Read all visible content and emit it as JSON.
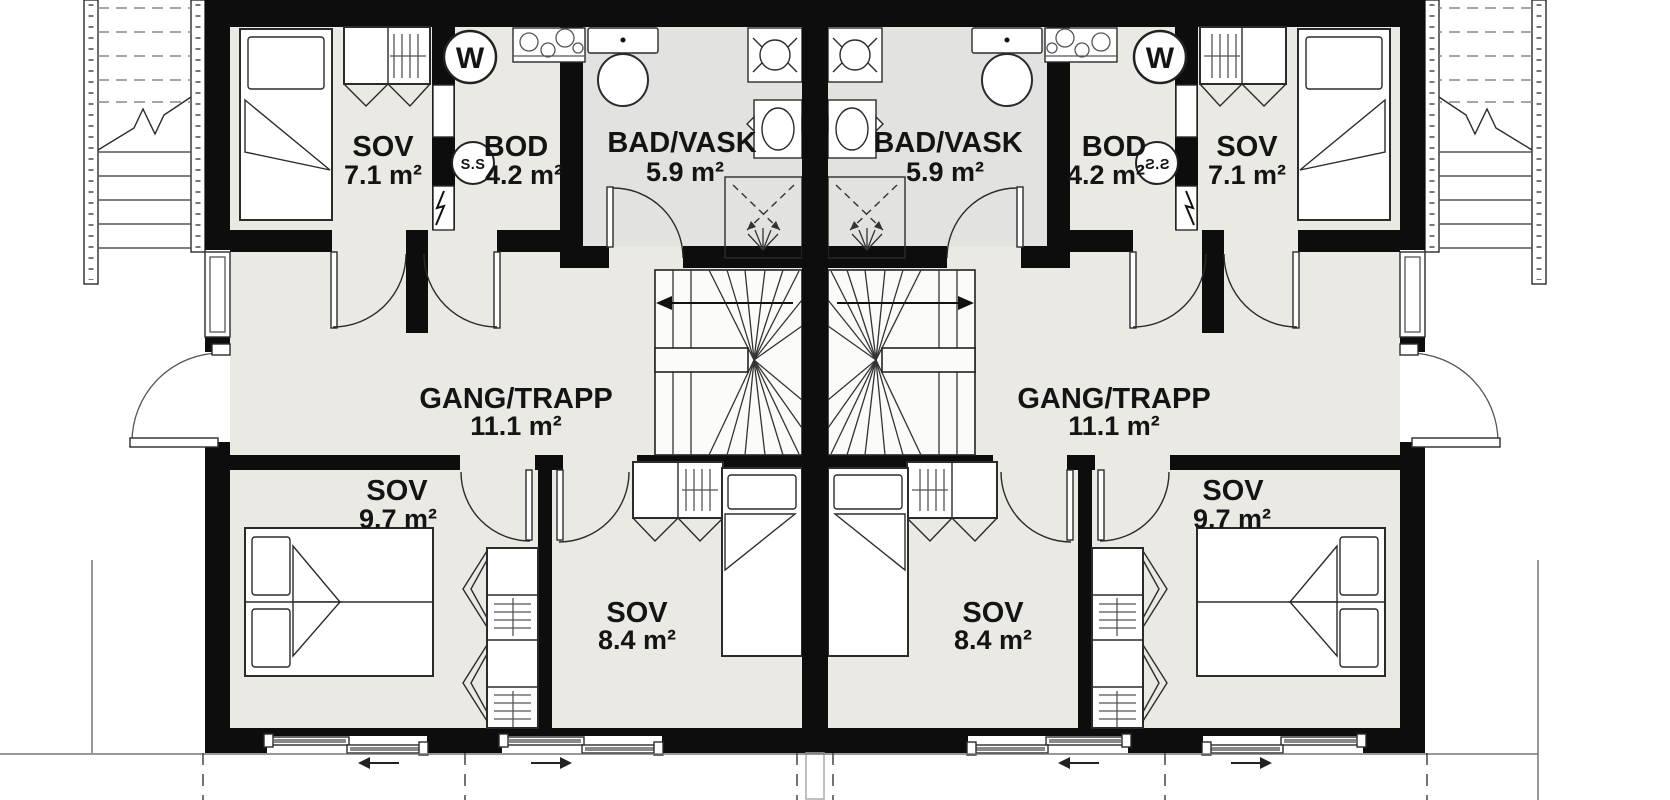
{
  "units": [
    {
      "id": "left",
      "rooms": [
        {
          "name": "SOV",
          "area": "7.1 m²"
        },
        {
          "name": "BOD",
          "area": "4.2 m²"
        },
        {
          "name": "BAD/VASK",
          "area": "5.9 m²"
        },
        {
          "name": "GANG/TRAPP",
          "area": "11.1 m²"
        },
        {
          "name": "SOV",
          "area": "9.7 m²"
        },
        {
          "name": "SOV",
          "area": "8.4 m²"
        }
      ],
      "labels": {
        "water_heater": "W",
        "fuse_cabinet": "S.S"
      }
    },
    {
      "id": "right",
      "rooms": [
        {
          "name": "SOV",
          "area": "7.1 m²"
        },
        {
          "name": "BOD",
          "area": "4.2 m²"
        },
        {
          "name": "BAD/VASK",
          "area": "5.9 m²"
        },
        {
          "name": "GANG/TRAPP",
          "area": "11.1 m²"
        },
        {
          "name": "SOV",
          "area": "9.7 m²"
        },
        {
          "name": "SOV",
          "area": "8.4 m²"
        }
      ],
      "labels": {
        "water_heater": "W",
        "fuse_cabinet": "S.S"
      }
    }
  ],
  "colors": {
    "wall": "#0d0d0d",
    "floor": "#eae9e4",
    "bath": "#e2e2df"
  }
}
